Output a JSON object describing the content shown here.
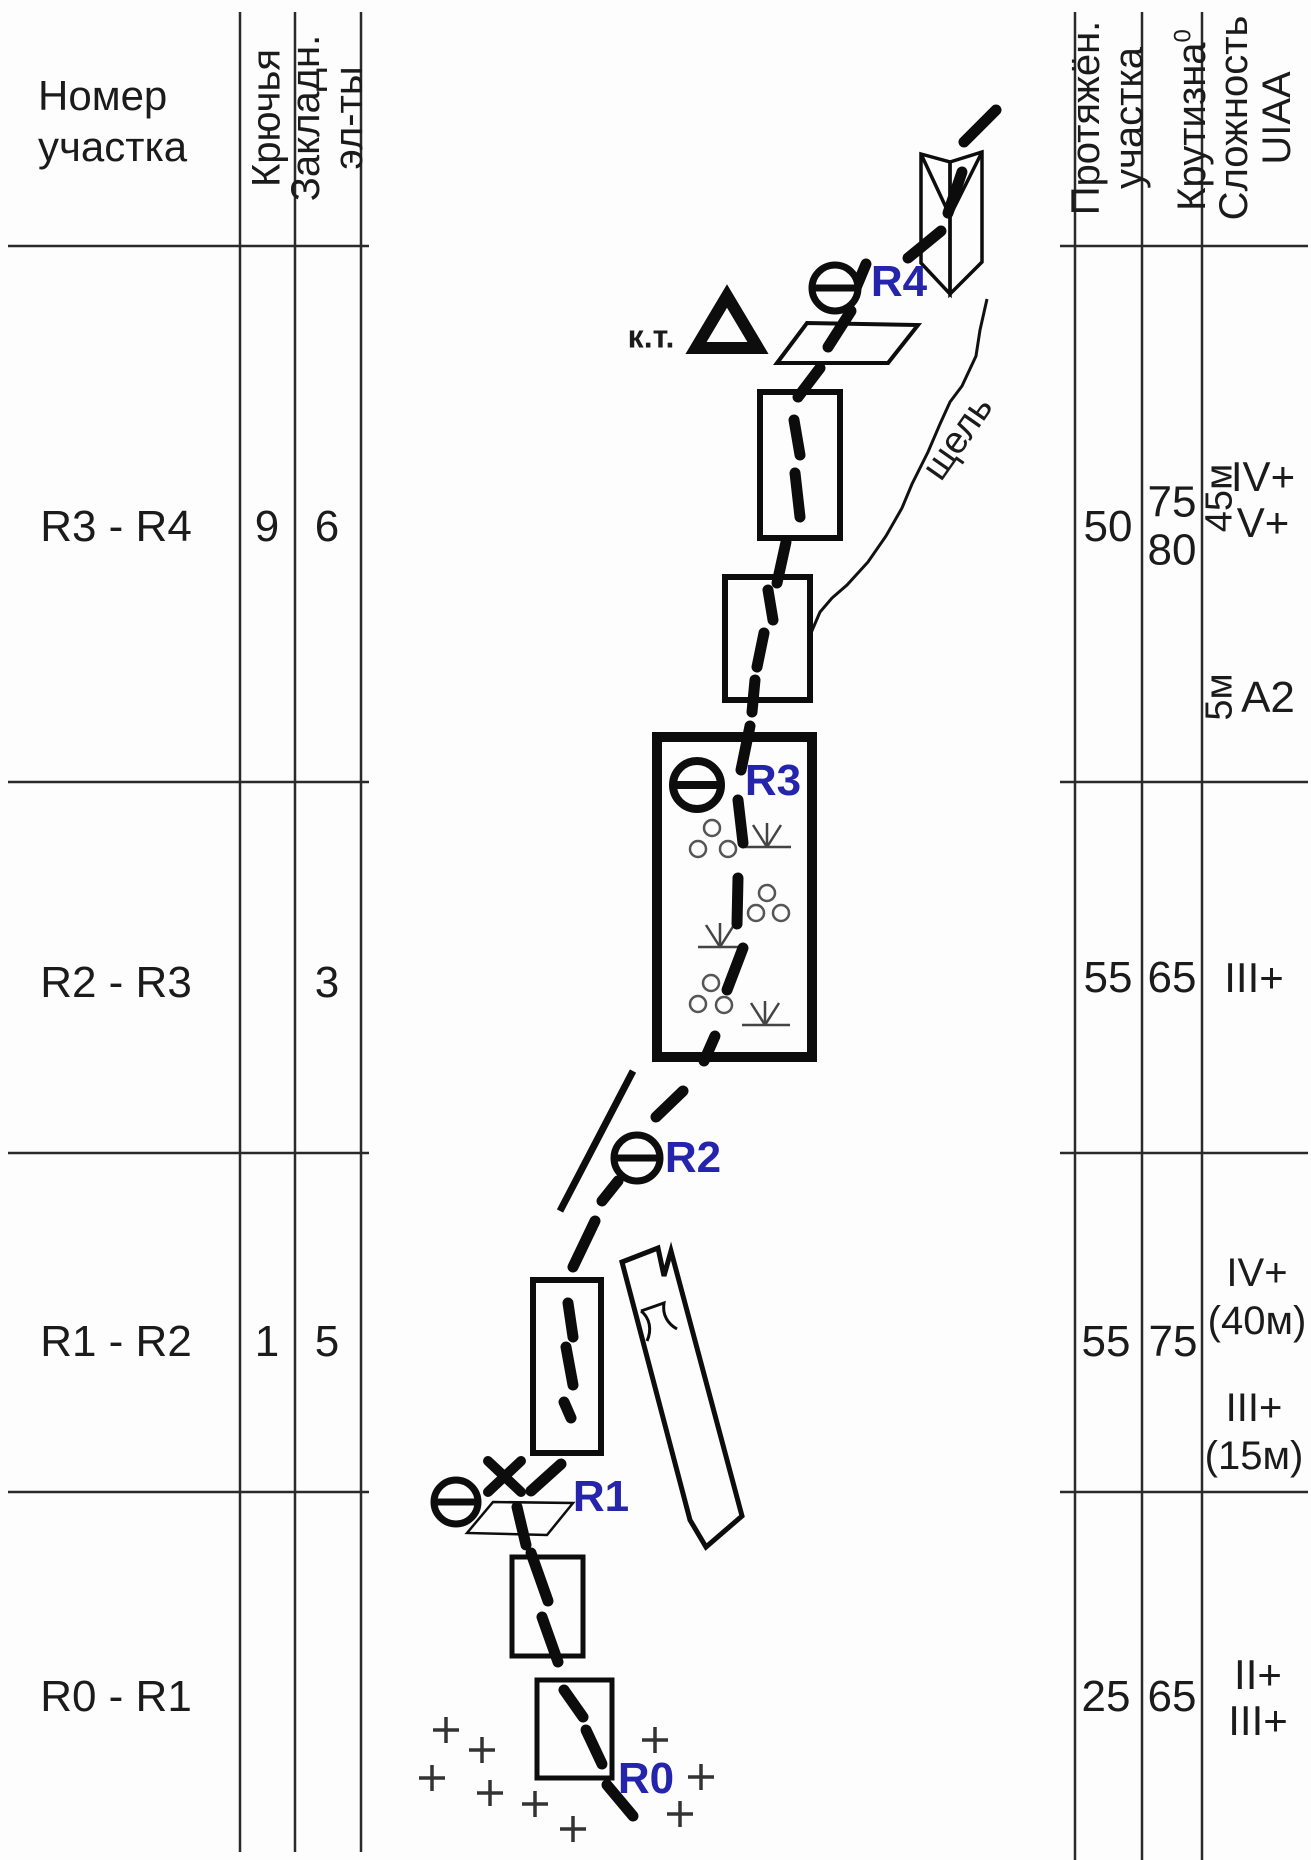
{
  "colors": {
    "ink": "#1b1b1b",
    "blue": "#2424ad"
  },
  "left_table": {
    "col_section": "Номер\nучастка",
    "col_pitons": "Крючья",
    "col_nuts": "Закладн.\nэл-ты"
  },
  "right_table": {
    "col_length": "Протяжён.\nучастка",
    "col_steepness": "Крутизна",
    "col_steepness_sup": "0",
    "col_difficulty": "Сложность\nUIAA"
  },
  "rows": [
    {
      "section": "R3 - R4",
      "pitons": "9",
      "nuts": "6",
      "length": "50",
      "steepness": "75\n80",
      "diff_rot_a": "45м",
      "diff_a": "IV+\nV+",
      "diff_rot_b": "5м",
      "diff_b": "A2"
    },
    {
      "section": "R2 - R3",
      "pitons": "",
      "nuts": "3",
      "length": "55",
      "steepness": "65",
      "diff_a": "III+"
    },
    {
      "section": "R1 - R2",
      "pitons": "1",
      "nuts": "5",
      "length": "55",
      "steepness": "75",
      "diff_a": "IV+\n(40м)",
      "diff_b": "III+\n(15м)"
    },
    {
      "section": "R0 - R1",
      "pitons": "",
      "nuts": "",
      "length": "25",
      "steepness": "65",
      "diff_a": "II+\nIII+"
    }
  ],
  "diagram": {
    "control_point": "к.т.",
    "crack": "щель",
    "belay_r4": "R4",
    "belay_r3": "R3",
    "belay_r2": "R2",
    "belay_r1": "R1",
    "start_r0": "R0"
  }
}
